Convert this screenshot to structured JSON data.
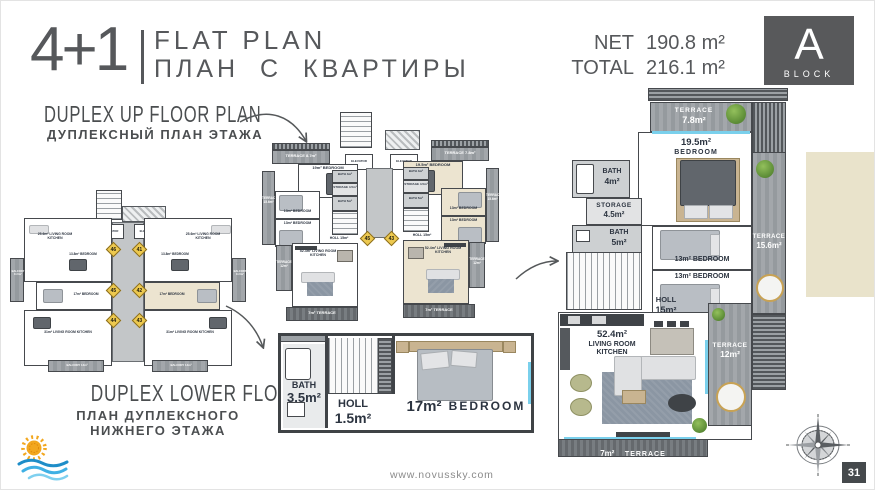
{
  "colors": {
    "accent_dark": "#56585b",
    "terrace_gray": "#9da2a6",
    "highlight_beige": "#ece4d0",
    "marker_yellow": "#edc94f",
    "window_blue": "#7ad0ec"
  },
  "header": {
    "unit_type": "4+1",
    "title_en": "FLAT PLAN",
    "title_ru": "ПЛАН С КВАРТИРЫ",
    "net_label": "NET",
    "net_value": "190.8 m²",
    "total_label": "TOTAL",
    "total_value": "216.1 m²",
    "block_letter": "A",
    "block_label": "BLOCK"
  },
  "annotations": {
    "duplex_up_en": "DUPLEX UP FLOOR PLAN",
    "duplex_up_ru": "ДУПЛЕКСНЫЙ ПЛАН ЭТАЖА",
    "duplex_lower_en": "DUPLEX LOWER FLOOR PLAN",
    "duplex_lower_ru1": "ПЛАН ДУПЛЕКСНОГО",
    "duplex_lower_ru2": "НИЖНЕГО ЭТАЖА"
  },
  "overview_plan": {
    "elevator": "ELEVATOR",
    "living_top": "25.6m² LIVING ROOM KITCHEN",
    "bedroom_top": "13.8m² BEDROOM",
    "balcony_side": "BALCONY 11.5m²",
    "bedroom_mid": "17m² BEDROOM",
    "living_bottom": "31m² LIVING ROOM KITCHEN",
    "balcony_bottom": "BALCONY 14m²",
    "marker_46": "46",
    "marker_41": "41",
    "marker_45": "45",
    "marker_42": "42",
    "marker_44": "44",
    "marker_43": "43"
  },
  "upper_plan": {
    "elevator": "ELEVATOR",
    "marker_left": "45",
    "marker_right": "43",
    "left": {
      "terrace_top": "TERRACE 8.7m²",
      "bedroom_big": "19m² BEDROOM",
      "terrace_side": "TERRACE 15.6m²",
      "bath_small": "BATH 4m²",
      "storage": "STORAGE 4.5m²",
      "bath": "BATH 5m²",
      "bedroom_a": "13m² BEDROOM",
      "bedroom_b": "13m² BEDROOM",
      "holl": "HOLL 15m²",
      "living": "52.4m² LIVING ROOM KITCHEN",
      "terrace_low": "TERRACE 12m²",
      "terrace_bottom": "7m² TERRACE"
    },
    "right": {
      "terrace_top": "TERRACE 7.8m²",
      "bedroom_big": "19.5m² BEDROOM",
      "terrace_side": "TERRACE 15.6m²",
      "bath_small": "BATH 4m²",
      "storage": "STORAGE 4.5m²",
      "bath": "BATH 5m²",
      "bedroom_a": "13m² BEDROOM",
      "bedroom_b": "13m² BEDROOM",
      "holl": "HOLL 15m²",
      "living": "52.4m² LIVING ROOM KITCHEN",
      "terrace_low": "TERRACE 12m²",
      "terrace_bottom": "7m² TERRACE"
    }
  },
  "lower_plan": {
    "bath_name": "BATH",
    "bath_area": "3.5m²",
    "holl_name": "HOLL",
    "holl_area": "1.5m²",
    "bedroom_area": "17m²",
    "bedroom_name": "BEDROOM"
  },
  "main_plan": {
    "terrace_top_name": "TERRACE",
    "terrace_top_area": "7.8m²",
    "bedroom_big_area": "19.5m²",
    "bedroom_big_name": "BEDROOM",
    "bath1_name": "BATH",
    "bath1_area": "4m²",
    "storage_name": "STORAGE",
    "storage_area": "4.5m²",
    "bath2_name": "BATH",
    "bath2_area": "5m²",
    "bedroom_a": "13m² BEDROOM",
    "bedroom_b": "13m² BEDROOM",
    "terrace_side_name": "TERRACE",
    "terrace_side_area": "15.6m²",
    "holl_name": "HOLL",
    "holl_area": "15m²",
    "living_area": "52.4m²",
    "living_name1": "LIVING ROOM",
    "living_name2": "KITCHEN",
    "terrace12_name": "TERRACE",
    "terrace12_area": "12m²",
    "terrace7_area": "7m²",
    "terrace7_name": "TERRACE"
  },
  "footer": {
    "website": "www.novussky.com",
    "page_number": "31"
  }
}
